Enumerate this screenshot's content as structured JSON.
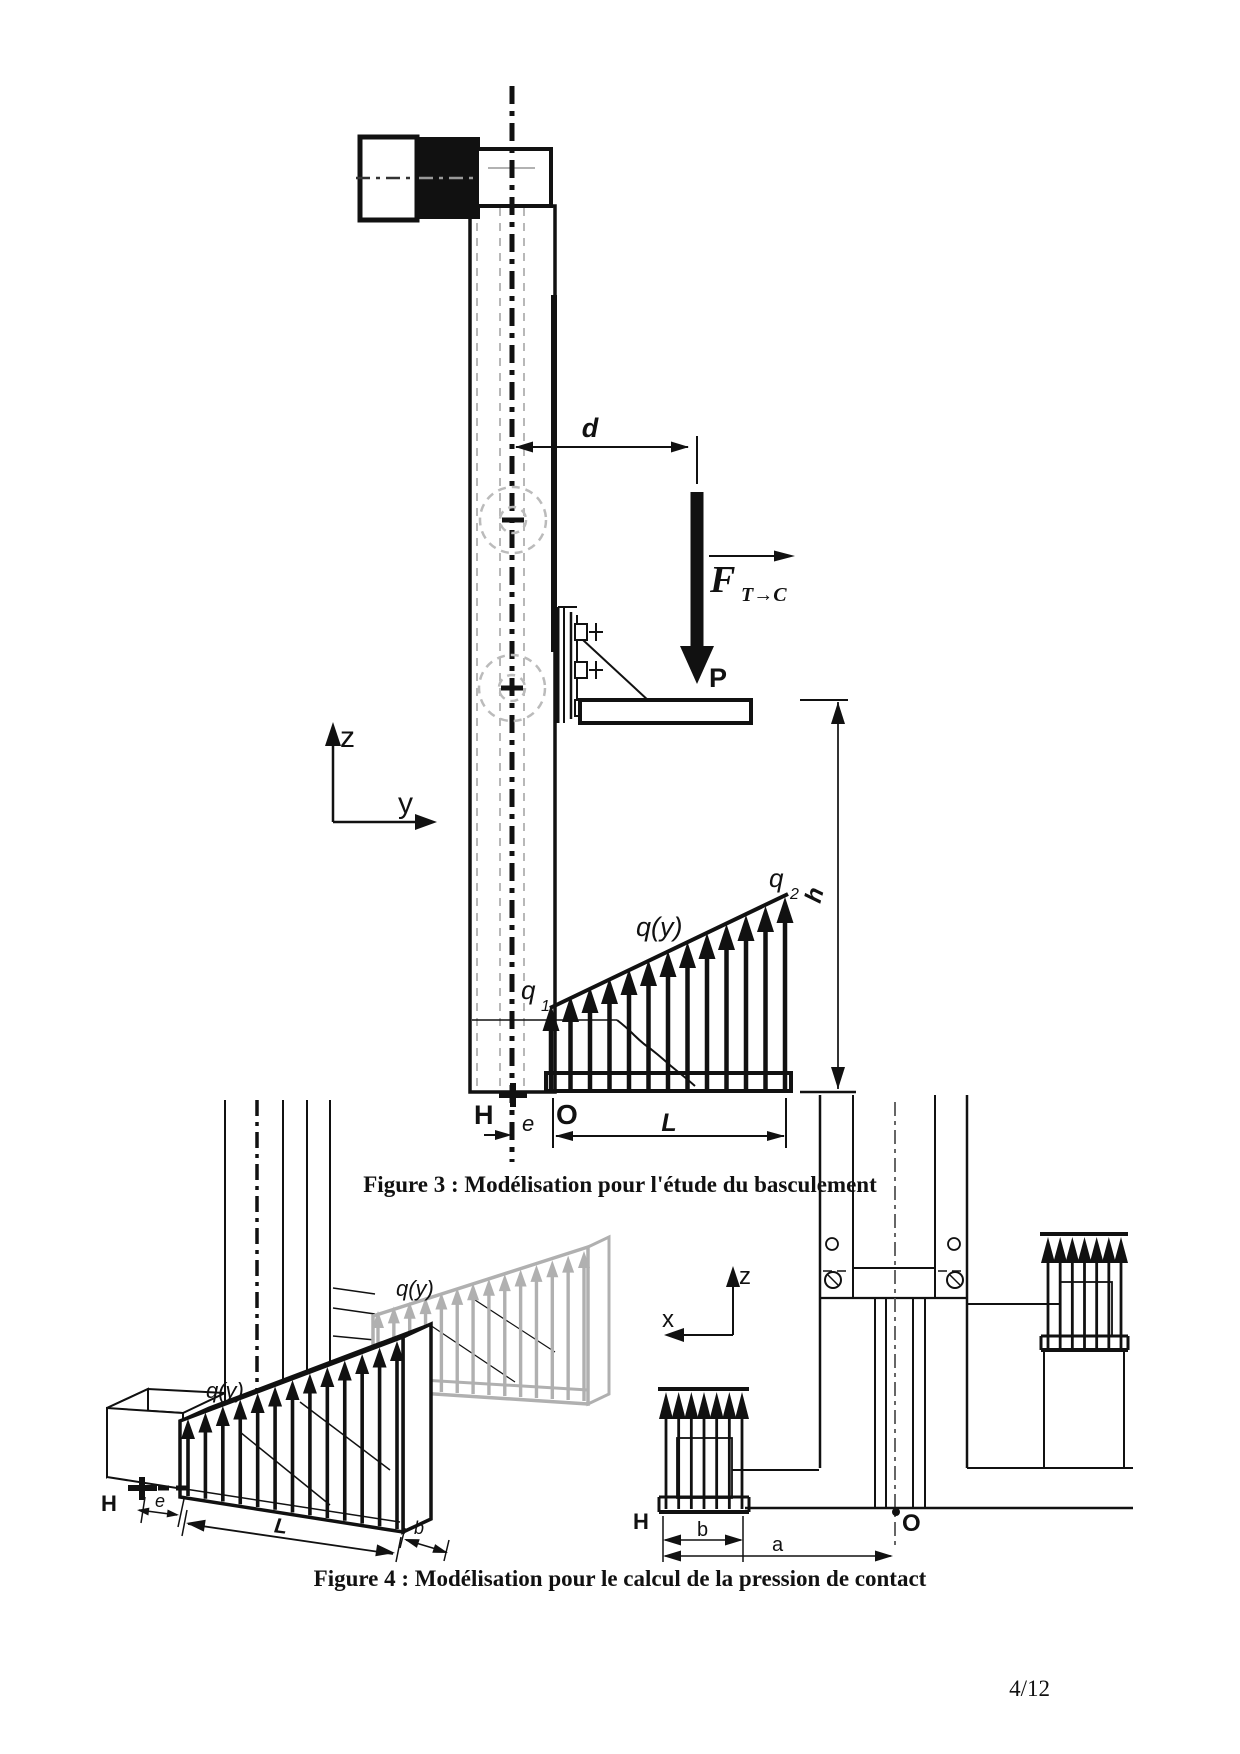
{
  "page": {
    "number": "4/12"
  },
  "figure3": {
    "caption": "Figure 3 : Modélisation pour l'étude du basculement",
    "labels": {
      "d": "d",
      "force_symbol": "F",
      "force_subscript": "T→C",
      "point_p": "P",
      "axis_z": "z",
      "axis_y": "y",
      "load_function": "q(y)",
      "q1_symbol": "q",
      "q1_subscript": "1",
      "q2_symbol": "q",
      "q2_subscript": "2",
      "h": "h",
      "point_h": "H",
      "e": "e",
      "origin_o": "O",
      "length_l": "L"
    }
  },
  "figure4": {
    "caption": "Figure 4 : Modélisation pour le calcul de la pression de contact",
    "left_view": {
      "load_function_front": "q(y)",
      "load_function_back": "q(y)",
      "point_h": "H",
      "e": "e",
      "length_l": "L",
      "width_b": "b"
    },
    "right_view": {
      "axis_z": "z",
      "axis_x": "x",
      "point_h": "H",
      "width_b": "b",
      "distance_a": "a",
      "origin_o": "O"
    }
  },
  "colors": {
    "ink": "#111111",
    "gray_line": "#b8b8b8",
    "gray_load": "#b0b0b0"
  }
}
